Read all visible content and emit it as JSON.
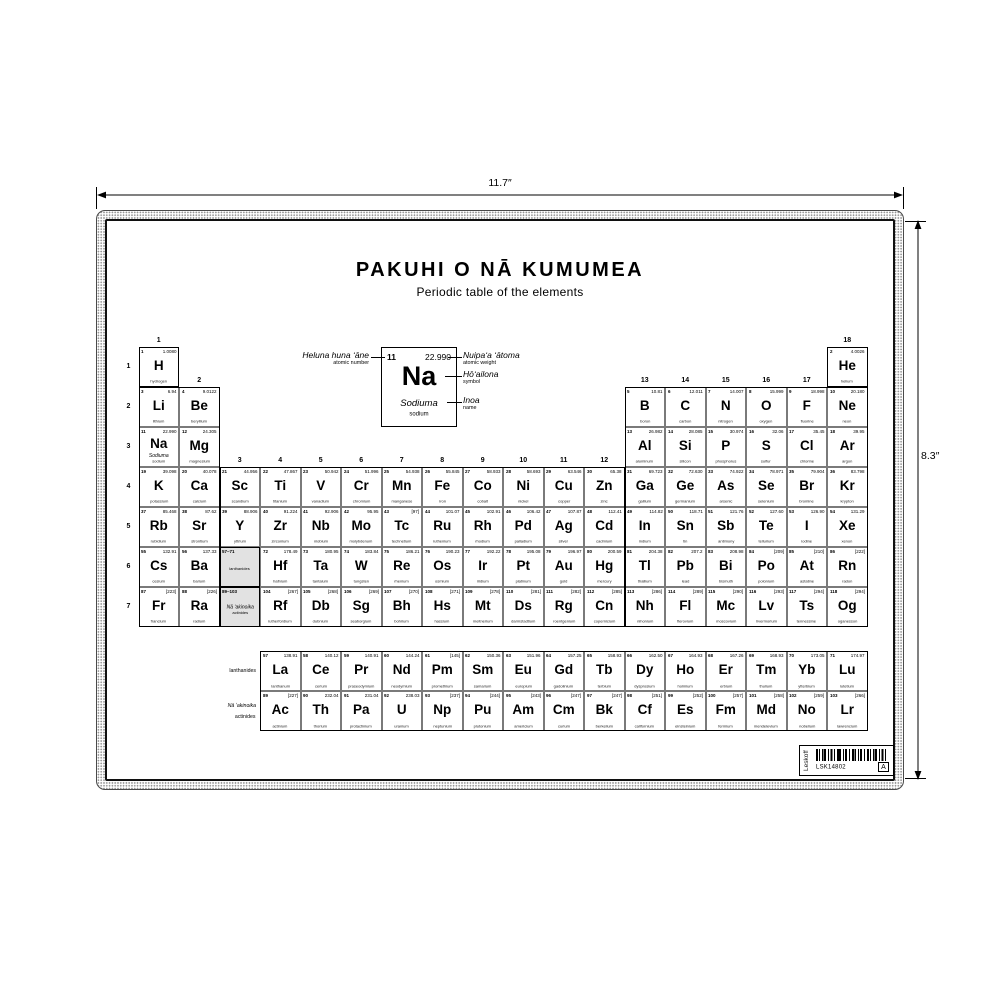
{
  "dimensions": {
    "width_label": "11.7″",
    "height_label": "8.3″"
  },
  "header": {
    "title": "PAKUHI O NĀ KUMUMEA",
    "subtitle": "Periodic table of the elements"
  },
  "legend": {
    "number": "11",
    "weight": "22.990",
    "symbol": "Na",
    "name_haw": "Sodiuma",
    "name_en": "sodium",
    "annotations": {
      "number": {
        "haw": "Heluna huna ʻāne",
        "en": "atomic number"
      },
      "weight": {
        "haw": "Nuipaʻa ʻātoma",
        "en": "atomic weight"
      },
      "symbol": {
        "haw": "Hōʻailona",
        "en": "symbol"
      },
      "name": {
        "haw": "Inoa",
        "en": "name"
      }
    }
  },
  "table": {
    "period_labels": [
      "1",
      "2",
      "3",
      "4",
      "5",
      "6",
      "7"
    ],
    "group_labels": [
      {
        "label": "1",
        "col": 1,
        "row": 1
      },
      {
        "label": "2",
        "col": 2,
        "row": 2
      },
      {
        "label": "3",
        "col": 3,
        "row": 4
      },
      {
        "label": "4",
        "col": 4,
        "row": 4
      },
      {
        "label": "5",
        "col": 5,
        "row": 4
      },
      {
        "label": "6",
        "col": 6,
        "row": 4
      },
      {
        "label": "7",
        "col": 7,
        "row": 4
      },
      {
        "label": "8",
        "col": 8,
        "row": 4
      },
      {
        "label": "9",
        "col": 9,
        "row": 4
      },
      {
        "label": "10",
        "col": 10,
        "row": 4
      },
      {
        "label": "11",
        "col": 11,
        "row": 4
      },
      {
        "label": "12",
        "col": 12,
        "row": 4
      },
      {
        "label": "13",
        "col": 13,
        "row": 2
      },
      {
        "label": "14",
        "col": 14,
        "row": 2
      },
      {
        "label": "15",
        "col": 15,
        "row": 2
      },
      {
        "label": "16",
        "col": 16,
        "row": 2
      },
      {
        "label": "17",
        "col": 17,
        "row": 2
      },
      {
        "label": "18",
        "col": 18,
        "row": 1
      }
    ],
    "placeholders": [
      {
        "range": "57–71",
        "lines": [
          "lanthanides"
        ],
        "g": 3,
        "p": 6
      },
      {
        "range": "89–103",
        "lines": [
          "Nā ʻakinoika",
          "actinides"
        ],
        "g": 3,
        "p": 7
      }
    ],
    "elements": [
      {
        "n": 1,
        "sym": "H",
        "wt": "1.0080",
        "name": "hydrogen",
        "p": 1,
        "g": 1
      },
      {
        "n": 2,
        "sym": "He",
        "wt": "4.0026",
        "name": "helium",
        "p": 1,
        "g": 18
      },
      {
        "n": 3,
        "sym": "Li",
        "wt": "6.94",
        "name": "lithium",
        "p": 2,
        "g": 1
      },
      {
        "n": 4,
        "sym": "Be",
        "wt": "9.0122",
        "name": "beryllium",
        "p": 2,
        "g": 2
      },
      {
        "n": 5,
        "sym": "B",
        "wt": "10.81",
        "name": "boron",
        "p": 2,
        "g": 13
      },
      {
        "n": 6,
        "sym": "C",
        "wt": "12.011",
        "name": "carbon",
        "p": 2,
        "g": 14
      },
      {
        "n": 7,
        "sym": "N",
        "wt": "14.007",
        "name": "nitrogen",
        "p": 2,
        "g": 15
      },
      {
        "n": 8,
        "sym": "O",
        "wt": "15.999",
        "name": "oxygen",
        "p": 2,
        "g": 16
      },
      {
        "n": 9,
        "sym": "F",
        "wt": "18.998",
        "name": "fluorine",
        "p": 2,
        "g": 17
      },
      {
        "n": 10,
        "sym": "Ne",
        "wt": "20.180",
        "name": "neon",
        "p": 2,
        "g": 18
      },
      {
        "n": 11,
        "sym": "Na",
        "wt": "22.990",
        "name": "sodium",
        "haw": "Sodiuma",
        "p": 3,
        "g": 1
      },
      {
        "n": 12,
        "sym": "Mg",
        "wt": "24.305",
        "name": "magnesium",
        "p": 3,
        "g": 2
      },
      {
        "n": 13,
        "sym": "Al",
        "wt": "26.982",
        "name": "aluminum",
        "p": 3,
        "g": 13
      },
      {
        "n": 14,
        "sym": "Si",
        "wt": "28.085",
        "name": "silicon",
        "p": 3,
        "g": 14
      },
      {
        "n": 15,
        "sym": "P",
        "wt": "30.974",
        "name": "phosphorus",
        "p": 3,
        "g": 15
      },
      {
        "n": 16,
        "sym": "S",
        "wt": "32.06",
        "name": "sulfur",
        "p": 3,
        "g": 16
      },
      {
        "n": 17,
        "sym": "Cl",
        "wt": "35.45",
        "name": "chlorine",
        "p": 3,
        "g": 17
      },
      {
        "n": 18,
        "sym": "Ar",
        "wt": "39.95",
        "name": "argon",
        "p": 3,
        "g": 18
      },
      {
        "n": 19,
        "sym": "K",
        "wt": "39.098",
        "name": "potassium",
        "p": 4,
        "g": 1
      },
      {
        "n": 20,
        "sym": "Ca",
        "wt": "40.078",
        "name": "calcium",
        "p": 4,
        "g": 2
      },
      {
        "n": 21,
        "sym": "Sc",
        "wt": "44.956",
        "name": "scandium",
        "p": 4,
        "g": 3
      },
      {
        "n": 22,
        "sym": "Ti",
        "wt": "47.867",
        "name": "titanium",
        "p": 4,
        "g": 4
      },
      {
        "n": 23,
        "sym": "V",
        "wt": "50.942",
        "name": "vanadium",
        "p": 4,
        "g": 5
      },
      {
        "n": 24,
        "sym": "Cr",
        "wt": "51.996",
        "name": "chromium",
        "p": 4,
        "g": 6
      },
      {
        "n": 25,
        "sym": "Mn",
        "wt": "54.938",
        "name": "manganese",
        "p": 4,
        "g": 7
      },
      {
        "n": 26,
        "sym": "Fe",
        "wt": "55.845",
        "name": "iron",
        "p": 4,
        "g": 8
      },
      {
        "n": 27,
        "sym": "Co",
        "wt": "58.933",
        "name": "cobalt",
        "p": 4,
        "g": 9
      },
      {
        "n": 28,
        "sym": "Ni",
        "wt": "58.693",
        "name": "nickel",
        "p": 4,
        "g": 10
      },
      {
        "n": 29,
        "sym": "Cu",
        "wt": "63.546",
        "name": "copper",
        "p": 4,
        "g": 11
      },
      {
        "n": 30,
        "sym": "Zn",
        "wt": "65.38",
        "name": "zinc",
        "p": 4,
        "g": 12
      },
      {
        "n": 31,
        "sym": "Ga",
        "wt": "69.723",
        "name": "gallium",
        "p": 4,
        "g": 13
      },
      {
        "n": 32,
        "sym": "Ge",
        "wt": "72.630",
        "name": "germanium",
        "p": 4,
        "g": 14
      },
      {
        "n": 33,
        "sym": "As",
        "wt": "74.922",
        "name": "arsenic",
        "p": 4,
        "g": 15
      },
      {
        "n": 34,
        "sym": "Se",
        "wt": "78.971",
        "name": "selenium",
        "p": 4,
        "g": 16
      },
      {
        "n": 35,
        "sym": "Br",
        "wt": "79.904",
        "name": "bromine",
        "p": 4,
        "g": 17
      },
      {
        "n": 36,
        "sym": "Kr",
        "wt": "83.798",
        "name": "krypton",
        "p": 4,
        "g": 18
      },
      {
        "n": 37,
        "sym": "Rb",
        "wt": "85.468",
        "name": "rubidium",
        "p": 5,
        "g": 1
      },
      {
        "n": 38,
        "sym": "Sr",
        "wt": "87.62",
        "name": "strontium",
        "p": 5,
        "g": 2
      },
      {
        "n": 39,
        "sym": "Y",
        "wt": "88.906",
        "name": "yttrium",
        "p": 5,
        "g": 3
      },
      {
        "n": 40,
        "sym": "Zr",
        "wt": "91.224",
        "name": "zirconium",
        "p": 5,
        "g": 4
      },
      {
        "n": 41,
        "sym": "Nb",
        "wt": "92.906",
        "name": "niobium",
        "p": 5,
        "g": 5
      },
      {
        "n": 42,
        "sym": "Mo",
        "wt": "95.95",
        "name": "molybdenum",
        "p": 5,
        "g": 6
      },
      {
        "n": 43,
        "sym": "Tc",
        "wt": "[97]",
        "name": "technetium",
        "p": 5,
        "g": 7
      },
      {
        "n": 44,
        "sym": "Ru",
        "wt": "101.07",
        "name": "ruthenium",
        "p": 5,
        "g": 8
      },
      {
        "n": 45,
        "sym": "Rh",
        "wt": "102.91",
        "name": "rhodium",
        "p": 5,
        "g": 9
      },
      {
        "n": 46,
        "sym": "Pd",
        "wt": "106.42",
        "name": "palladium",
        "p": 5,
        "g": 10
      },
      {
        "n": 47,
        "sym": "Ag",
        "wt": "107.87",
        "name": "silver",
        "p": 5,
        "g": 11
      },
      {
        "n": 48,
        "sym": "Cd",
        "wt": "112.41",
        "name": "cadmium",
        "p": 5,
        "g": 12
      },
      {
        "n": 49,
        "sym": "In",
        "wt": "114.82",
        "name": "indium",
        "p": 5,
        "g": 13
      },
      {
        "n": 50,
        "sym": "Sn",
        "wt": "118.71",
        "name": "tin",
        "p": 5,
        "g": 14
      },
      {
        "n": 51,
        "sym": "Sb",
        "wt": "121.76",
        "name": "antimony",
        "p": 5,
        "g": 15
      },
      {
        "n": 52,
        "sym": "Te",
        "wt": "127.60",
        "name": "tellurium",
        "p": 5,
        "g": 16
      },
      {
        "n": 53,
        "sym": "I",
        "wt": "126.90",
        "name": "iodine",
        "p": 5,
        "g": 17
      },
      {
        "n": 54,
        "sym": "Xe",
        "wt": "131.29",
        "name": "xenon",
        "p": 5,
        "g": 18
      },
      {
        "n": 55,
        "sym": "Cs",
        "wt": "132.91",
        "name": "cesium",
        "p": 6,
        "g": 1
      },
      {
        "n": 56,
        "sym": "Ba",
        "wt": "137.33",
        "name": "barium",
        "p": 6,
        "g": 2
      },
      {
        "n": 72,
        "sym": "Hf",
        "wt": "178.49",
        "name": "hafnium",
        "p": 6,
        "g": 4
      },
      {
        "n": 73,
        "sym": "Ta",
        "wt": "180.95",
        "name": "tantalum",
        "p": 6,
        "g": 5
      },
      {
        "n": 74,
        "sym": "W",
        "wt": "183.84",
        "name": "tungsten",
        "p": 6,
        "g": 6
      },
      {
        "n": 75,
        "sym": "Re",
        "wt": "186.21",
        "name": "rhenium",
        "p": 6,
        "g": 7
      },
      {
        "n": 76,
        "sym": "Os",
        "wt": "190.23",
        "name": "osmium",
        "p": 6,
        "g": 8
      },
      {
        "n": 77,
        "sym": "Ir",
        "wt": "192.22",
        "name": "iridium",
        "p": 6,
        "g": 9
      },
      {
        "n": 78,
        "sym": "Pt",
        "wt": "195.08",
        "name": "platinum",
        "p": 6,
        "g": 10
      },
      {
        "n": 79,
        "sym": "Au",
        "wt": "196.97",
        "name": "gold",
        "p": 6,
        "g": 11
      },
      {
        "n": 80,
        "sym": "Hg",
        "wt": "200.59",
        "name": "mercury",
        "p": 6,
        "g": 12
      },
      {
        "n": 81,
        "sym": "Tl",
        "wt": "204.38",
        "name": "thallium",
        "p": 6,
        "g": 13
      },
      {
        "n": 82,
        "sym": "Pb",
        "wt": "207.2",
        "name": "lead",
        "p": 6,
        "g": 14
      },
      {
        "n": 83,
        "sym": "Bi",
        "wt": "208.98",
        "name": "bismuth",
        "p": 6,
        "g": 15
      },
      {
        "n": 84,
        "sym": "Po",
        "wt": "[209]",
        "name": "polonium",
        "p": 6,
        "g": 16
      },
      {
        "n": 85,
        "sym": "At",
        "wt": "[210]",
        "name": "astatine",
        "p": 6,
        "g": 17
      },
      {
        "n": 86,
        "sym": "Rn",
        "wt": "[222]",
        "name": "radon",
        "p": 6,
        "g": 18
      },
      {
        "n": 87,
        "sym": "Fr",
        "wt": "[223]",
        "name": "francium",
        "p": 7,
        "g": 1
      },
      {
        "n": 88,
        "sym": "Ra",
        "wt": "[226]",
        "name": "radium",
        "p": 7,
        "g": 2
      },
      {
        "n": 104,
        "sym": "Rf",
        "wt": "[267]",
        "name": "rutherfordium",
        "p": 7,
        "g": 4
      },
      {
        "n": 105,
        "sym": "Db",
        "wt": "[268]",
        "name": "dubnium",
        "p": 7,
        "g": 5
      },
      {
        "n": 106,
        "sym": "Sg",
        "wt": "[269]",
        "name": "seaborgium",
        "p": 7,
        "g": 6
      },
      {
        "n": 107,
        "sym": "Bh",
        "wt": "[270]",
        "name": "bohrium",
        "p": 7,
        "g": 7
      },
      {
        "n": 108,
        "sym": "Hs",
        "wt": "[271]",
        "name": "hassium",
        "p": 7,
        "g": 8
      },
      {
        "n": 109,
        "sym": "Mt",
        "wt": "[278]",
        "name": "meitnerium",
        "p": 7,
        "g": 9
      },
      {
        "n": 110,
        "sym": "Ds",
        "wt": "[281]",
        "name": "darmstadtium",
        "p": 7,
        "g": 10
      },
      {
        "n": 111,
        "sym": "Rg",
        "wt": "[282]",
        "name": "roentgenium",
        "p": 7,
        "g": 11
      },
      {
        "n": 112,
        "sym": "Cn",
        "wt": "[285]",
        "name": "copernicium",
        "p": 7,
        "g": 12
      },
      {
        "n": 113,
        "sym": "Nh",
        "wt": "[286]",
        "name": "nihonium",
        "p": 7,
        "g": 13
      },
      {
        "n": 114,
        "sym": "Fl",
        "wt": "[289]",
        "name": "flerovium",
        "p": 7,
        "g": 14
      },
      {
        "n": 115,
        "sym": "Mc",
        "wt": "[290]",
        "name": "moscovium",
        "p": 7,
        "g": 15
      },
      {
        "n": 116,
        "sym": "Lv",
        "wt": "[293]",
        "name": "livermorium",
        "p": 7,
        "g": 16
      },
      {
        "n": 117,
        "sym": "Ts",
        "wt": "[294]",
        "name": "tennessine",
        "p": 7,
        "g": 17
      },
      {
        "n": 118,
        "sym": "Og",
        "wt": "[294]",
        "name": "oganesson",
        "p": 7,
        "g": 18
      }
    ]
  },
  "bottom": {
    "row_labels": {
      "lanthanides": "lanthanides",
      "actinides_haw": "Nā ʻakinoika",
      "actinides_en": "actinides"
    },
    "lanthanides": [
      {
        "n": 57,
        "sym": "La",
        "wt": "138.91",
        "name": "lanthanum"
      },
      {
        "n": 58,
        "sym": "Ce",
        "wt": "140.12",
        "name": "cerium"
      },
      {
        "n": 59,
        "sym": "Pr",
        "wt": "140.91",
        "name": "praseodymium"
      },
      {
        "n": 60,
        "sym": "Nd",
        "wt": "144.24",
        "name": "neodymium"
      },
      {
        "n": 61,
        "sym": "Pm",
        "wt": "[145]",
        "name": "promethium"
      },
      {
        "n": 62,
        "sym": "Sm",
        "wt": "150.36",
        "name": "samarium"
      },
      {
        "n": 63,
        "sym": "Eu",
        "wt": "151.96",
        "name": "europium"
      },
      {
        "n": 64,
        "sym": "Gd",
        "wt": "157.25",
        "name": "gadolinium"
      },
      {
        "n": 65,
        "sym": "Tb",
        "wt": "158.93",
        "name": "terbium"
      },
      {
        "n": 66,
        "sym": "Dy",
        "wt": "162.50",
        "name": "dysprosium"
      },
      {
        "n": 67,
        "sym": "Ho",
        "wt": "164.93",
        "name": "holmium"
      },
      {
        "n": 68,
        "sym": "Er",
        "wt": "167.26",
        "name": "erbium"
      },
      {
        "n": 69,
        "sym": "Tm",
        "wt": "168.93",
        "name": "thulium"
      },
      {
        "n": 70,
        "sym": "Yb",
        "wt": "173.05",
        "name": "ytterbium"
      },
      {
        "n": 71,
        "sym": "Lu",
        "wt": "174.97",
        "name": "lutetium"
      }
    ],
    "actinides": [
      {
        "n": 89,
        "sym": "Ac",
        "wt": "[227]",
        "name": "actinium"
      },
      {
        "n": 90,
        "sym": "Th",
        "wt": "232.04",
        "name": "thorium"
      },
      {
        "n": 91,
        "sym": "Pa",
        "wt": "231.04",
        "name": "protactinium"
      },
      {
        "n": 92,
        "sym": "U",
        "wt": "238.03",
        "name": "uranium"
      },
      {
        "n": 93,
        "sym": "Np",
        "wt": "[237]",
        "name": "neptunium"
      },
      {
        "n": 94,
        "sym": "Pu",
        "wt": "[244]",
        "name": "plutonium"
      },
      {
        "n": 95,
        "sym": "Am",
        "wt": "[243]",
        "name": "americium"
      },
      {
        "n": 96,
        "sym": "Cm",
        "wt": "[247]",
        "name": "curium"
      },
      {
        "n": 97,
        "sym": "Bk",
        "wt": "[247]",
        "name": "berkelium"
      },
      {
        "n": 98,
        "sym": "Cf",
        "wt": "[251]",
        "name": "californium"
      },
      {
        "n": 99,
        "sym": "Es",
        "wt": "[252]",
        "name": "einsteinium"
      },
      {
        "n": 100,
        "sym": "Fm",
        "wt": "[257]",
        "name": "fermium"
      },
      {
        "n": 101,
        "sym": "Md",
        "wt": "[258]",
        "name": "mendelevium"
      },
      {
        "n": 102,
        "sym": "No",
        "wt": "[259]",
        "name": "nobelium"
      },
      {
        "n": 103,
        "sym": "Lr",
        "wt": "[266]",
        "name": "lawrencium"
      }
    ]
  },
  "footer": {
    "brand": "Leskoff",
    "code": "LSK14802",
    "revision": "A"
  },
  "colors": {
    "ink": "#000000",
    "placeholder_bg": "#e2e2e2",
    "paper": "#ffffff"
  }
}
